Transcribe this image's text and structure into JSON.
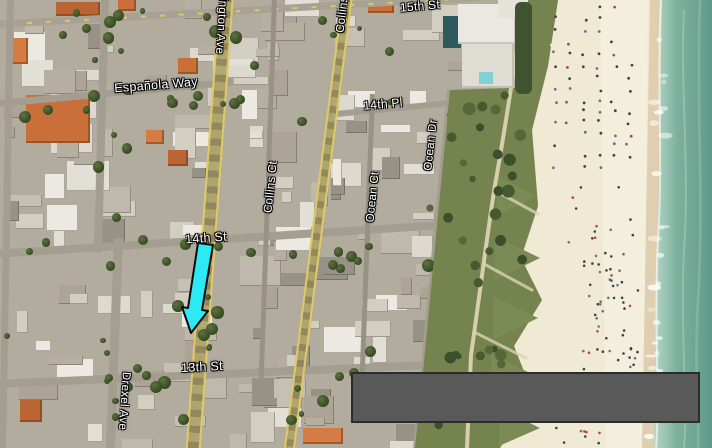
{
  "map": {
    "description": "Satellite aerial map of Miami Beach with highlight arrow and gray overlay box",
    "street_labels": [
      {
        "id": "fifteenth-st",
        "text": "15th St"
      },
      {
        "id": "espanola-way",
        "text": "Española Way"
      },
      {
        "id": "fourteenth-pl",
        "text": "14th Pl"
      },
      {
        "id": "fourteenth-st",
        "text": "14th St"
      },
      {
        "id": "thirteenth-st",
        "text": "13th St"
      },
      {
        "id": "washington-ave",
        "text": "Washington Ave"
      },
      {
        "id": "collins-ave",
        "text": "Collins Ave"
      },
      {
        "id": "collins-ct",
        "text": "Collins Ct"
      },
      {
        "id": "ocean-ct",
        "text": "Ocean Ct"
      },
      {
        "id": "ocean-dr",
        "text": "Ocean Dr"
      },
      {
        "id": "drexel-ave",
        "text": "Drexel Ave"
      }
    ],
    "annotations": {
      "arrow_fill": "#2ce9f4",
      "arrow_outline": "#0d0d0d",
      "overlay_box_fill": "#595959",
      "overlay_box_border": "#2c2c2c"
    },
    "palette": {
      "road_major_edge": "#dfc968",
      "water_deep": "#5e9a88",
      "water_shallow": "#b5d6c6",
      "sand": "#f0e9d3",
      "wet_sand": "#dccaa9",
      "park_green": "#75834e",
      "city_base": "#b2ac9f",
      "roof_orange": "#c9703a"
    }
  }
}
